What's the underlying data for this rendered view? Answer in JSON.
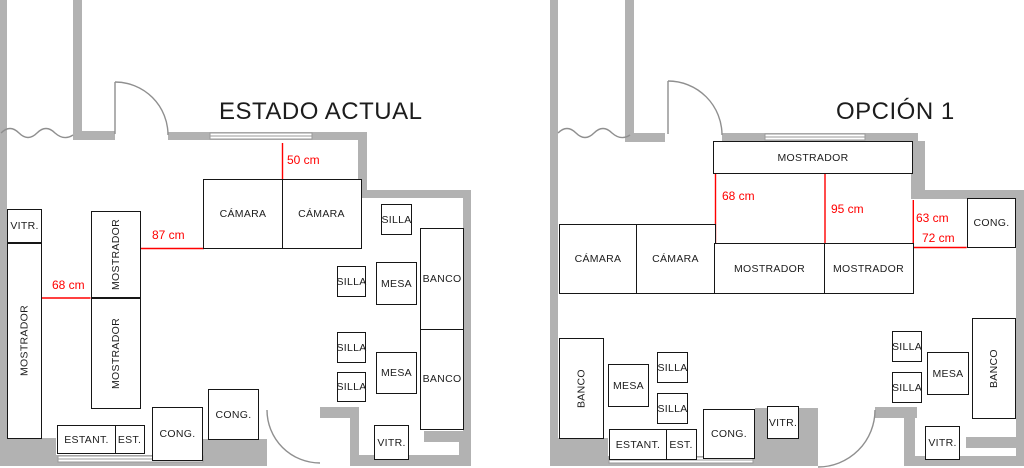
{
  "colors": {
    "wall_gray": "#b2b2b2",
    "door_line_gray": "#8f8f8f",
    "dimension_red": "#ff0000",
    "furniture_border_black": "#161616"
  },
  "plans": [
    {
      "title": "ESTADO ACTUAL",
      "dimensions": [
        "50 cm",
        "87 cm",
        "68 cm"
      ],
      "boxes": [
        "VITR.",
        "MOSTRADOR",
        "MOSTRADOR",
        "MOSTRADOR",
        "CÁMARA",
        "CÁMARA",
        "SILLA",
        "SILLA",
        "MESA",
        "BANCO",
        "SILLA",
        "SILLA",
        "MESA",
        "BANCO",
        "VITR.",
        "CONG.",
        "CONG.",
        "ESTANT.",
        "EST."
      ]
    },
    {
      "title": "OPCIÓN 1",
      "dimensions": [
        "68 cm",
        "95 cm",
        "63 cm",
        "72 cm"
      ],
      "boxes": [
        "MOSTRADOR",
        "CÁMARA",
        "CÁMARA",
        "MOSTRADOR",
        "MOSTRADOR",
        "CONG.",
        "BANCO",
        "MESA",
        "SILLA",
        "SILLA",
        "ESTANT.",
        "EST.",
        "CONG.",
        "VITR.",
        "SILLA",
        "SILLA",
        "MESA",
        "BANCO",
        "VITR."
      ]
    }
  ]
}
